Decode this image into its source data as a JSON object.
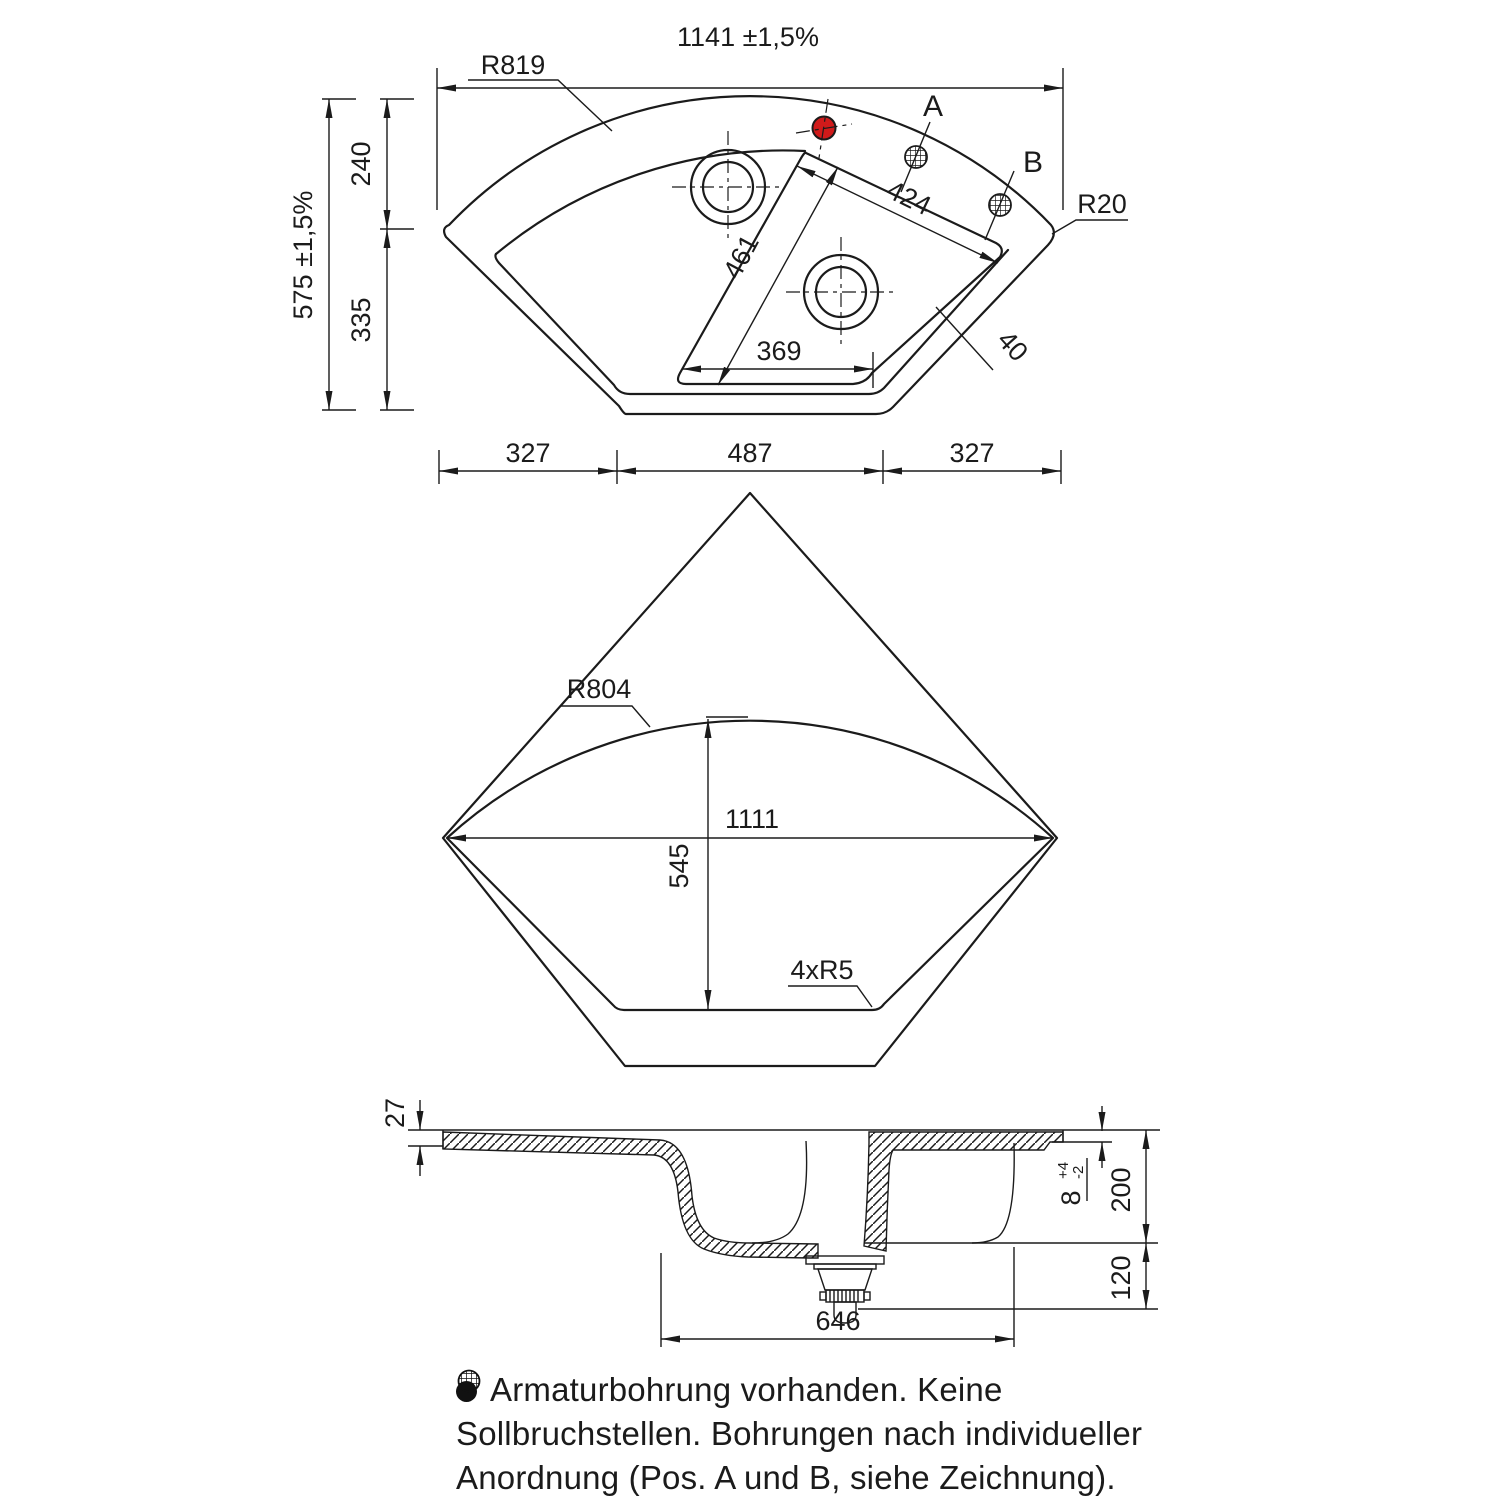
{
  "views": {
    "top": {
      "dims": {
        "width": "1141 ±1,5%",
        "height": "575 ±1,5%",
        "height_top": "240",
        "height_bottom": "335",
        "bottom_left": "327",
        "bottom_mid": "487",
        "bottom_right": "327",
        "basin_edge_top": "424",
        "basin_edge_left": "461",
        "basin_bottom": "369",
        "rim_strip": "40"
      },
      "labels": {
        "radius_outer": "R819",
        "radius_corner": "R20",
        "pos_a": "A",
        "pos_b": "B"
      }
    },
    "middle": {
      "dims": {
        "width": "1111",
        "height": "545"
      },
      "labels": {
        "radius_arc": "R804",
        "corners": "4xR5"
      }
    },
    "section": {
      "dims": {
        "rim": "27",
        "step": "8",
        "step_plus": "+4",
        "step_minus": "-2",
        "depth": "200",
        "drain": "120",
        "width": "646"
      }
    }
  },
  "note": {
    "line1": "Armaturbohrung vorhanden. Keine",
    "line2": "Sollbruchstellen. Bohrungen nach individueller",
    "line3_pre": "Anordnung (",
    "line3_post": "Pos. A und B, siehe Zeichnung)."
  },
  "colors": {
    "line": "#1b1b1b",
    "faucet_hole_fill": "#d01a1a"
  }
}
